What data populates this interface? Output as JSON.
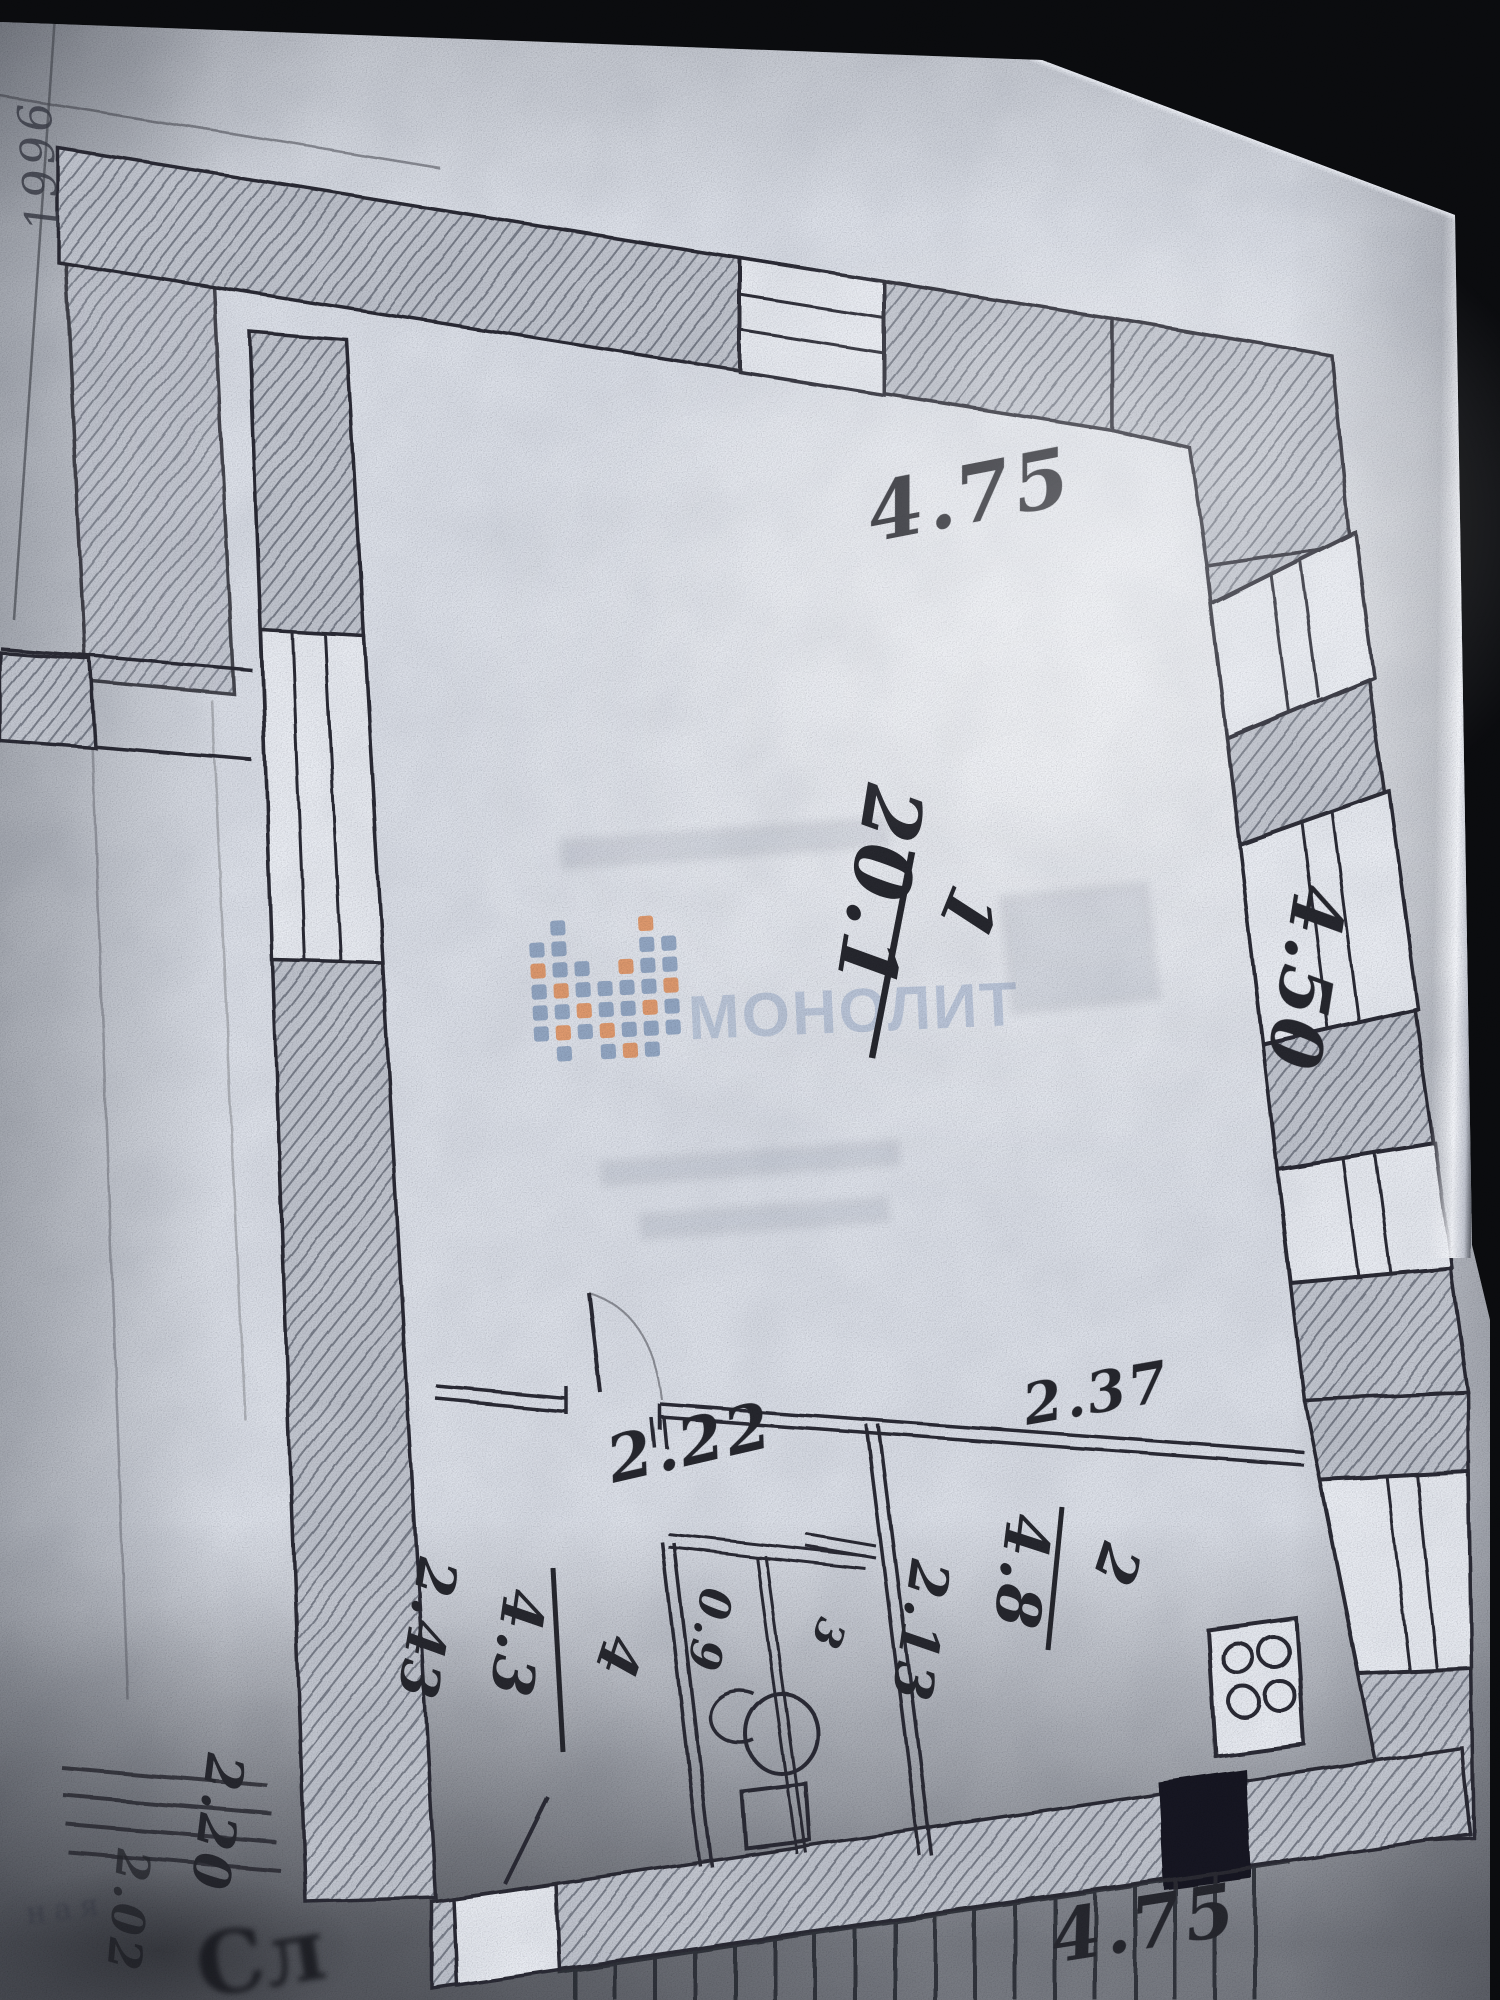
{
  "watermark": {
    "wordmark": "МОНОЛИТ",
    "logo": "mosaic-m-icon",
    "colors": {
      "tile_blue": "#93a7c3",
      "tile_orange": "#e09a6e",
      "wordmark": "#b7c3d7"
    }
  },
  "page": {
    "margin_year": "1996",
    "stamp_text": "ная",
    "stamp_mark": "Сл"
  },
  "plan": {
    "rooms": [
      {
        "id": "living-room",
        "number": "1",
        "area": "20.1"
      },
      {
        "id": "kitchen",
        "number": "2",
        "area": "4.8"
      },
      {
        "id": "wc",
        "number": "3",
        "area": "0.9"
      },
      {
        "id": "hall",
        "number": "4",
        "area": "4.3"
      }
    ],
    "dimensions": {
      "room1_width_top": "4.75",
      "room1_depth_right": "4.50",
      "hall_width": "2.22",
      "kitchen_width": "2.37",
      "hall_depth": "2.43",
      "kitchen_depth": "2.13",
      "balcony_width_bottom": "4.75",
      "stair_depth": "2.20",
      "stair_width": "2.02"
    },
    "fixtures": [
      "stove",
      "toilet",
      "sink",
      "balcony-door"
    ]
  }
}
